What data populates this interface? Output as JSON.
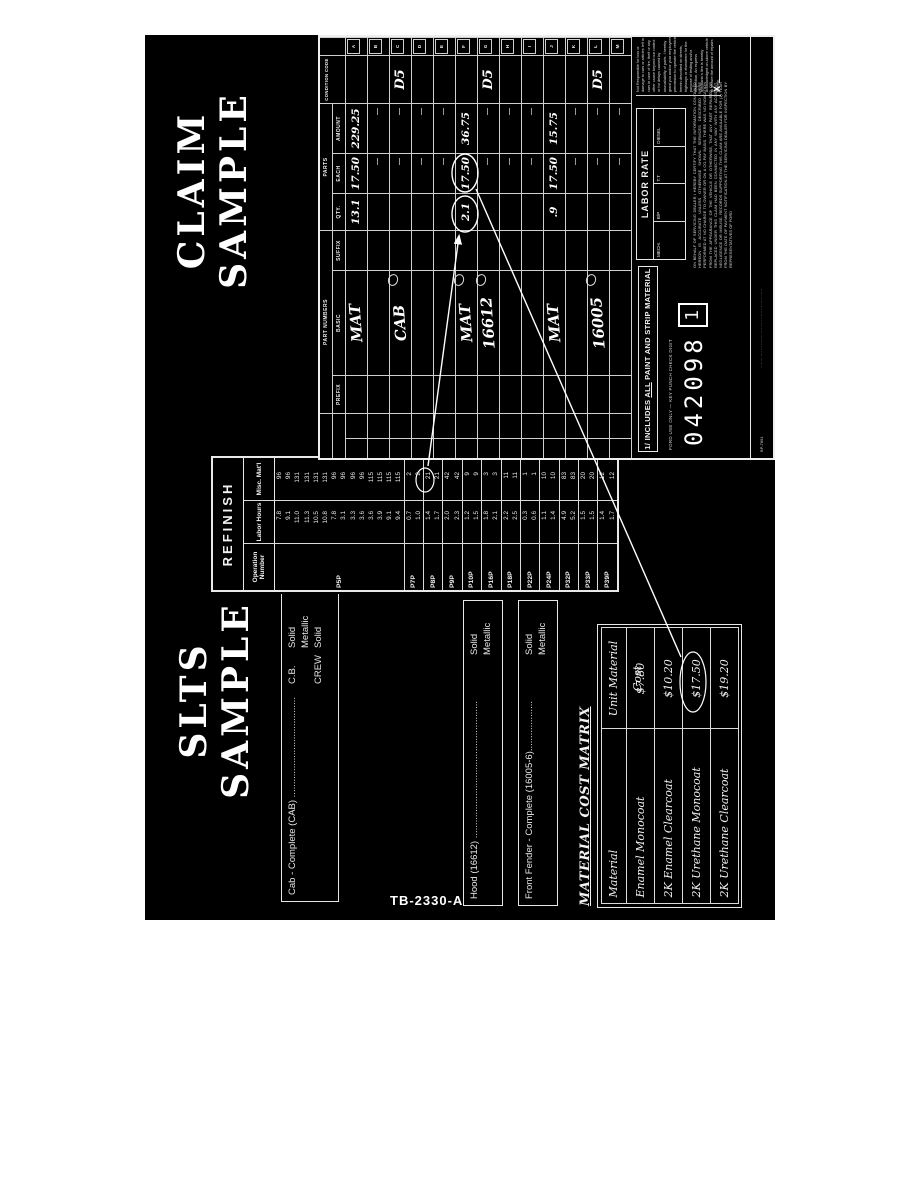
{
  "figure_label": "TB-2330-A",
  "slts": {
    "title": [
      "SLTS",
      "SAMPLE"
    ],
    "notes": {
      "cab": {
        "rows": [
          [
            "Cab - Complete (CAB) ......................................",
            "C.B.",
            "Solid"
          ],
          [
            "",
            "",
            "Metallic"
          ],
          [
            "",
            "CREW",
            "Solid"
          ]
        ]
      },
      "hood": {
        "rows": [
          [
            "Hood (16612) ....................................................",
            "",
            "Solid"
          ],
          [
            "",
            "",
            "Metallic"
          ]
        ]
      },
      "fender": {
        "rows": [
          [
            "Front Fender - Complete (16005-6)...................",
            "",
            "Solid"
          ],
          [
            "",
            "",
            "Metallic"
          ]
        ]
      }
    },
    "refinish": {
      "title": "REFINISH",
      "headers": [
        "Operation Number",
        "Labor Hours",
        "Misc. Mat'l"
      ],
      "groups": [
        {
          "op": "P5P",
          "rows": [
            [
              "7.8",
              "96"
            ],
            [
              "9.1",
              "96"
            ],
            [
              "11.0",
              "131"
            ],
            [
              "11.3",
              "131"
            ],
            [
              "10.5",
              "131"
            ],
            [
              "10.8",
              "131"
            ],
            [
              "7.8",
              "96"
            ],
            [
              "3.1",
              "96"
            ],
            [
              "3.3",
              "96"
            ],
            [
              "3.6",
              "96"
            ],
            [
              "3.6",
              "115"
            ],
            [
              "3.9",
              "115"
            ],
            [
              "9.1",
              "115"
            ],
            [
              "9.4",
              "115"
            ]
          ]
        },
        {
          "op": "P7P",
          "rows": [
            [
              "0.7",
              "2"
            ],
            [
              "1.0",
              "2"
            ]
          ]
        },
        {
          "op": "P8P",
          "rows": [
            [
              "1.4",
              "21"
            ],
            [
              "1.7",
              "21"
            ]
          ],
          "circled": "21"
        },
        {
          "op": "P9P",
          "rows": [
            [
              "2.0",
              "42"
            ],
            [
              "2.3",
              "42"
            ]
          ]
        },
        {
          "op": "P10P",
          "rows": [
            [
              "1.2",
              "9"
            ],
            [
              "1.5",
              "9"
            ]
          ]
        },
        {
          "op": "P16P",
          "rows": [
            [
              "1.8",
              "3"
            ],
            [
              "2.1",
              "3"
            ]
          ]
        },
        {
          "op": "P18P",
          "rows": [
            [
              "2.2",
              "11"
            ],
            [
              "2.5",
              "11"
            ]
          ]
        },
        {
          "op": "P22P",
          "rows": [
            [
              "0.3",
              "1"
            ],
            [
              "0.6",
              "1"
            ]
          ]
        },
        {
          "op": "P24P",
          "rows": [
            [
              "1.1",
              "10"
            ],
            [
              "1.4",
              "10"
            ]
          ]
        },
        {
          "op": "P32P",
          "rows": [
            [
              "4.9",
              "83"
            ],
            [
              "5.2",
              "83"
            ]
          ]
        },
        {
          "op": "P33P",
          "rows": [
            [
              "1.5",
              "20"
            ],
            [
              "1.5",
              "20"
            ]
          ]
        },
        {
          "op": "P39P",
          "rows": [
            [
              "1.4",
              "12"
            ],
            [
              "1.7",
              "12"
            ]
          ]
        }
      ]
    },
    "matrix": {
      "title": "MATERIAL COST MATRIX",
      "headers": [
        "Material",
        "Unit Material Cost"
      ],
      "rows": [
        [
          "Enamel Monocoat",
          "$7.80"
        ],
        [
          "2K Enamel Clearcoat",
          "$10.20"
        ],
        [
          "2K Urethane Monocoat",
          "$17.50"
        ],
        [
          "2K Urethane Clearcoat",
          "$19.20"
        ]
      ],
      "circled_value": "$17.50"
    }
  },
  "claim": {
    "title": [
      "CLAIM",
      "SAMPLE"
    ],
    "group_headers": {
      "part_numbers": "PART NUMBERS",
      "parts": "PARTS",
      "condition": "CONDITION CODE"
    },
    "column_labels": [
      "PREFIX",
      "BASIC",
      "SUFFIX",
      "QTY.",
      "EACH",
      "AMOUNT"
    ],
    "line_letters": [
      "A",
      "B",
      "C",
      "D",
      "E",
      "F",
      "G",
      "H",
      "I",
      "J",
      "K",
      "L",
      "M"
    ],
    "rows": [
      {
        "letter": "A",
        "basic": "MAT",
        "qty": "13.1",
        "each": "17.50",
        "amount": "229.25"
      },
      {
        "letter": "B"
      },
      {
        "letter": "C",
        "basic": "CAB",
        "cond": "D5",
        "scribble": true
      },
      {
        "letter": "D"
      },
      {
        "letter": "E"
      },
      {
        "letter": "F",
        "basic": "MAT",
        "qty": "2.1",
        "each": "17.50",
        "amount": "36.75",
        "scribble": true,
        "circled": true
      },
      {
        "letter": "G",
        "basic": "16612",
        "cond": "D5",
        "scribble": true
      },
      {
        "letter": "H"
      },
      {
        "letter": "I"
      },
      {
        "letter": "J",
        "basic": "MAT",
        "qty": ".9",
        "each": "17.50",
        "amount": "15.75"
      },
      {
        "letter": "K"
      },
      {
        "letter": "L",
        "basic": "16005",
        "cond": "D5",
        "scribble": true
      },
      {
        "letter": "M"
      }
    ],
    "footnote": {
      "prefix": "1/ INCLUDES",
      "underlined": "ALL",
      "suffix": "PAINT AND STRIP MATERIAL"
    },
    "punch": {
      "label": "FORD USE ONLY — KEY PUNCH CHECK DIGIT",
      "number": "042098",
      "check_digit": "1"
    },
    "labor_rate": {
      "title": "LABOR RATE",
      "cells": [
        "MECH.",
        "B/P",
        "T.T",
        "DIESEL"
      ]
    },
    "certification": "ON BEHALF OF SERVICING DEALER I HEREBY CERTIFY THAT THE INFORMATION CONTAINED HEREON IS ACCURATE UNLESS OTHERWISE SHOWN. SERVICES DESCRIBED WERE PERFORMED AT NO CHARGE TO OWNER OR ON A CO-PAY BASIS. THERE WAS NO INDICATION FROM THE APPEARANCE OF THE VEHICLE OR OTHERWISE, THAT ANY PART REPAIRED OR REPLACED UNDER THIS CLAIM HAD BEEN CONNECTED IN ANY WAY WITH ANY ACCIDENT, NEGLIGENCE OR MISUSE. RECORDS SUPPORTING THIS CLAIM ARE AVAILABLE FOR (1) YEAR FROM THE DATE OF PAYMENT NOTIFICATION AT THE SERVICING DEALER FOR INSPECTION BY REPRESENTATIVES OF FORD",
    "disclaimer": "Not Responsible for loss or damage to cars or articles left in cars in case of fire, theft or any other cause beyond our control or for delays caused by unavailability of parts. I hereby grant you and/or your employees permission to operate the vehicle herein described on streets, highways or elsewhere for the purpose of testing and/or inspection. An express mechanic's lien is hereby acknowledged on above vehicle to secure the amount of repairs thereto.",
    "signature_mark": "X",
    "bottom_strip": {
      "left": "BP-7891",
      "center": "·· ····· ···· ··· ········ ···· ····· ······ ··· ······ ·····"
    }
  },
  "colors": {
    "paper": "#ffffff",
    "scan_bg": "#000000",
    "ink": "#ffffff",
    "grid_line": "#cfcfcf"
  }
}
